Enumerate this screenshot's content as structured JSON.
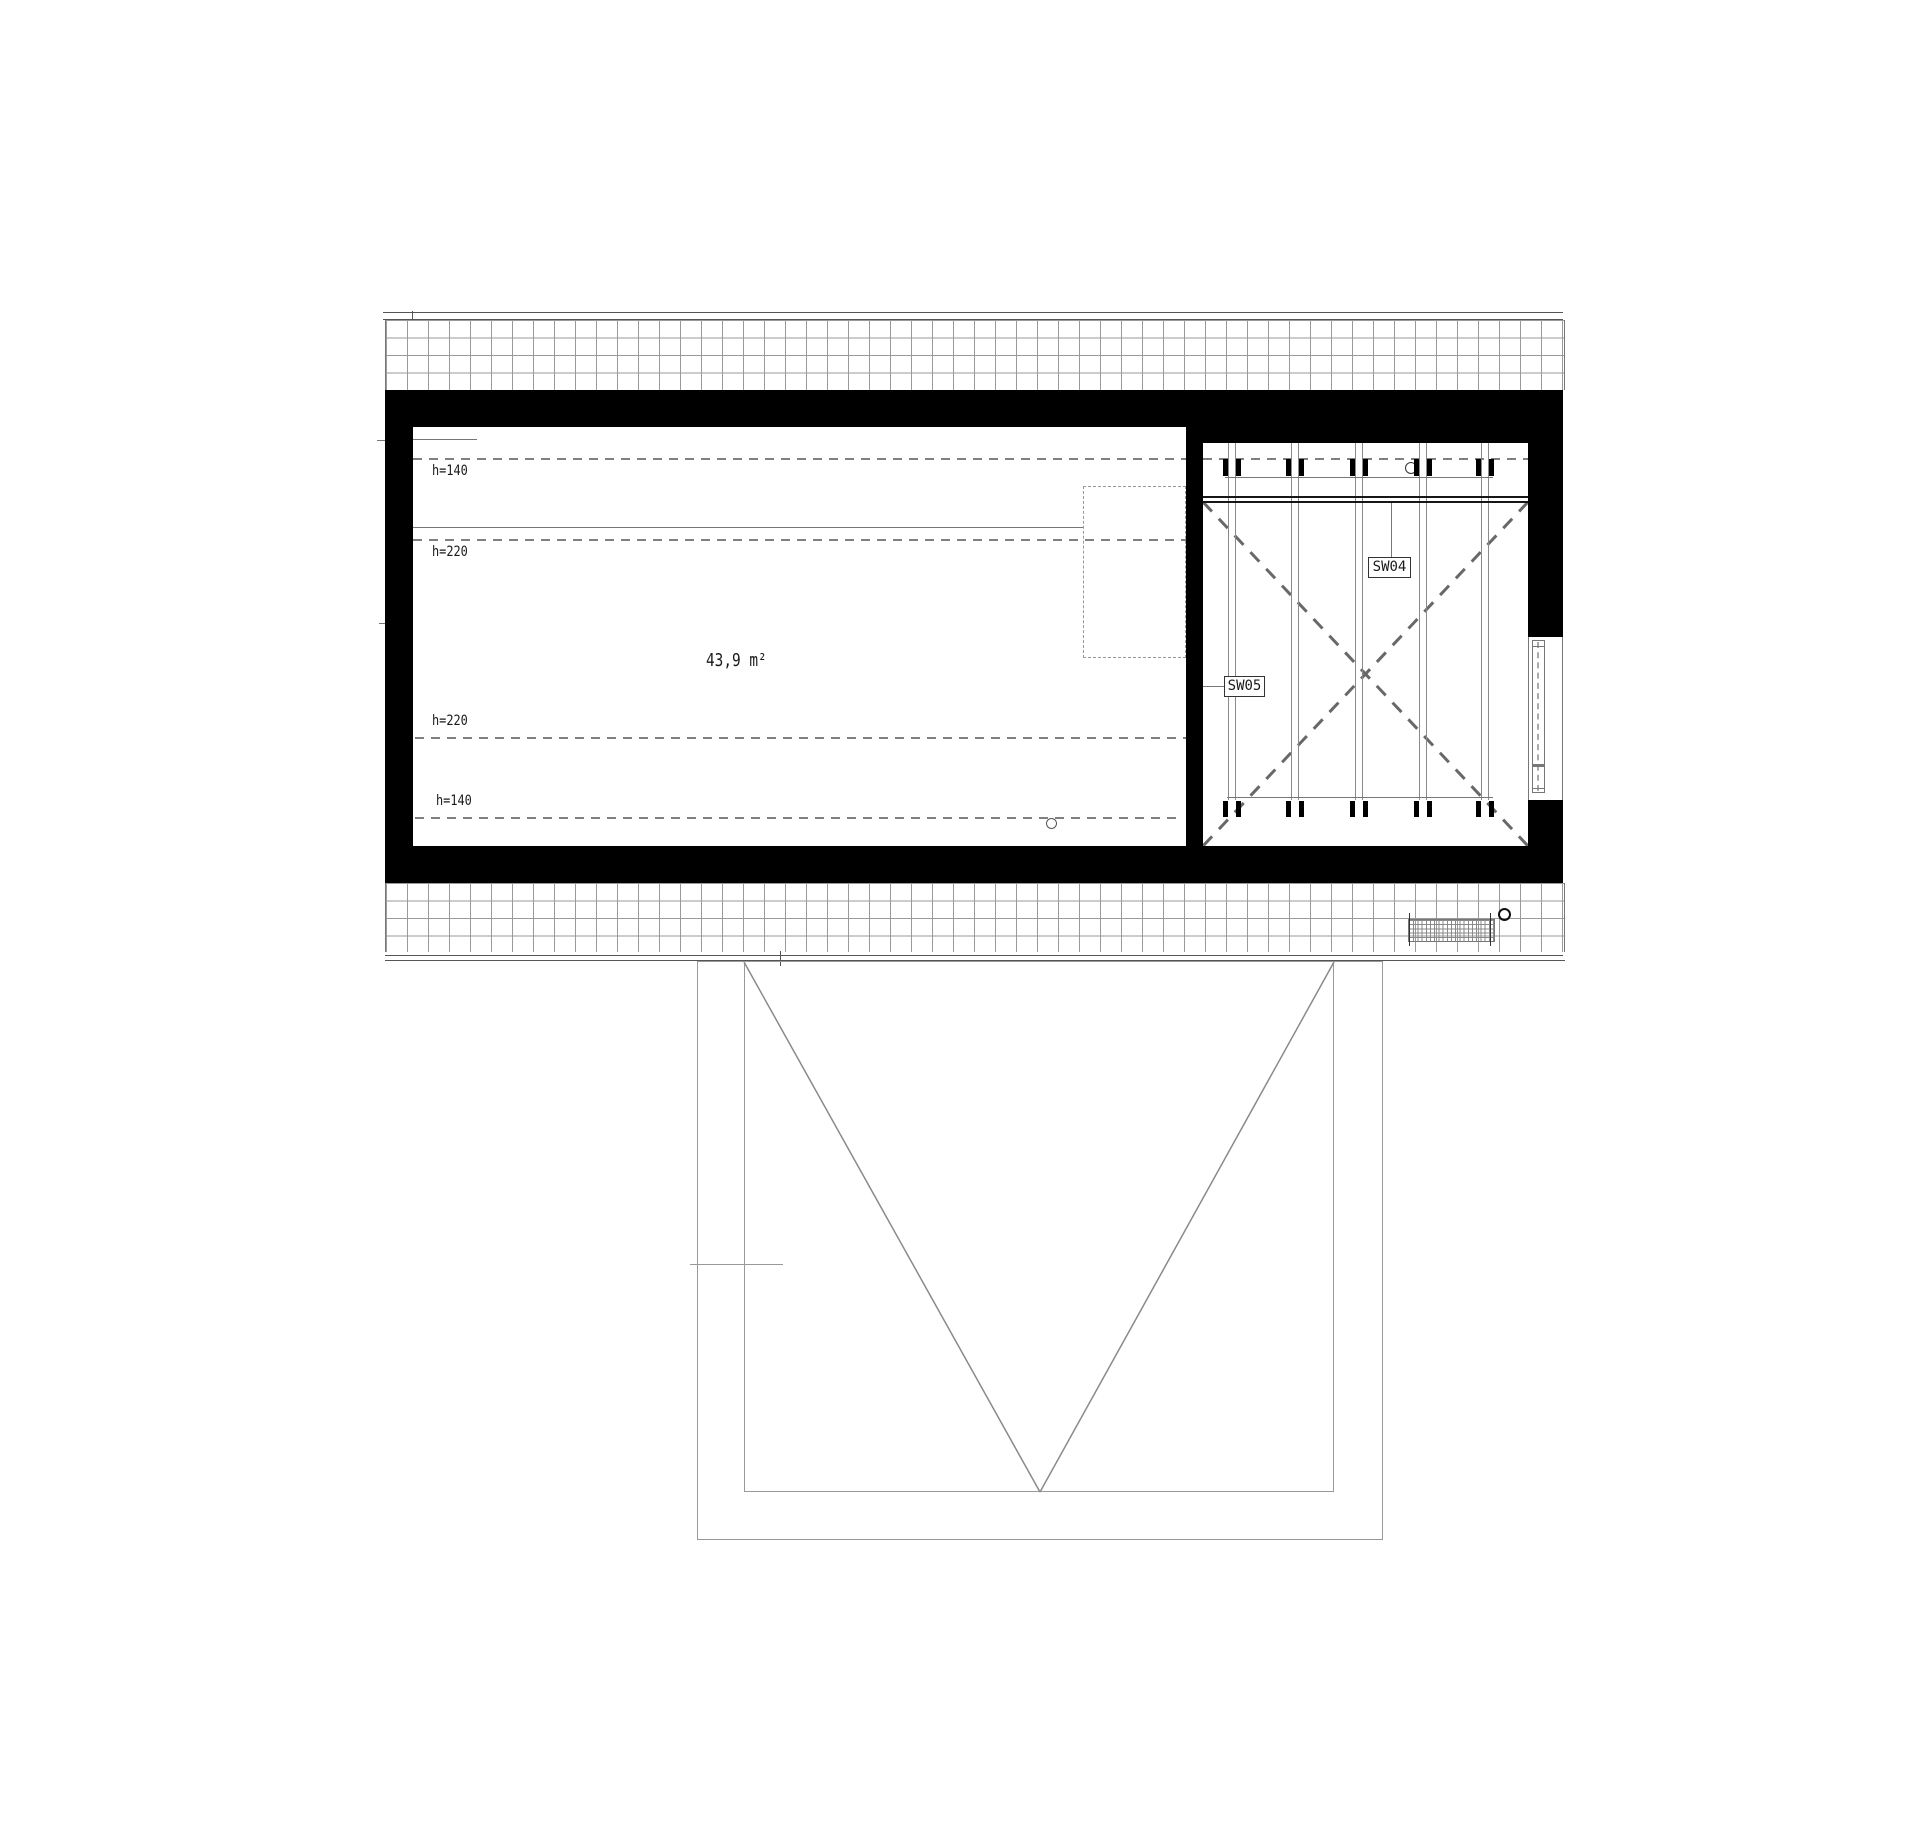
{
  "plan": {
    "title": "attic floor plan",
    "area_label": "43,9 m²",
    "height_labels": [
      "h=140",
      "h=220",
      "h=220",
      "h=140"
    ],
    "panel_labels": {
      "sw04": "SW04",
      "sw05": "SW05"
    },
    "colors": {
      "wall": "#000000",
      "thin_line": "#777777",
      "dashed_line": "#808080",
      "hatch_line": "#9a9a9a",
      "brace_line": "#686868",
      "text": "#1a1a1a",
      "background": "#ffffff"
    }
  }
}
